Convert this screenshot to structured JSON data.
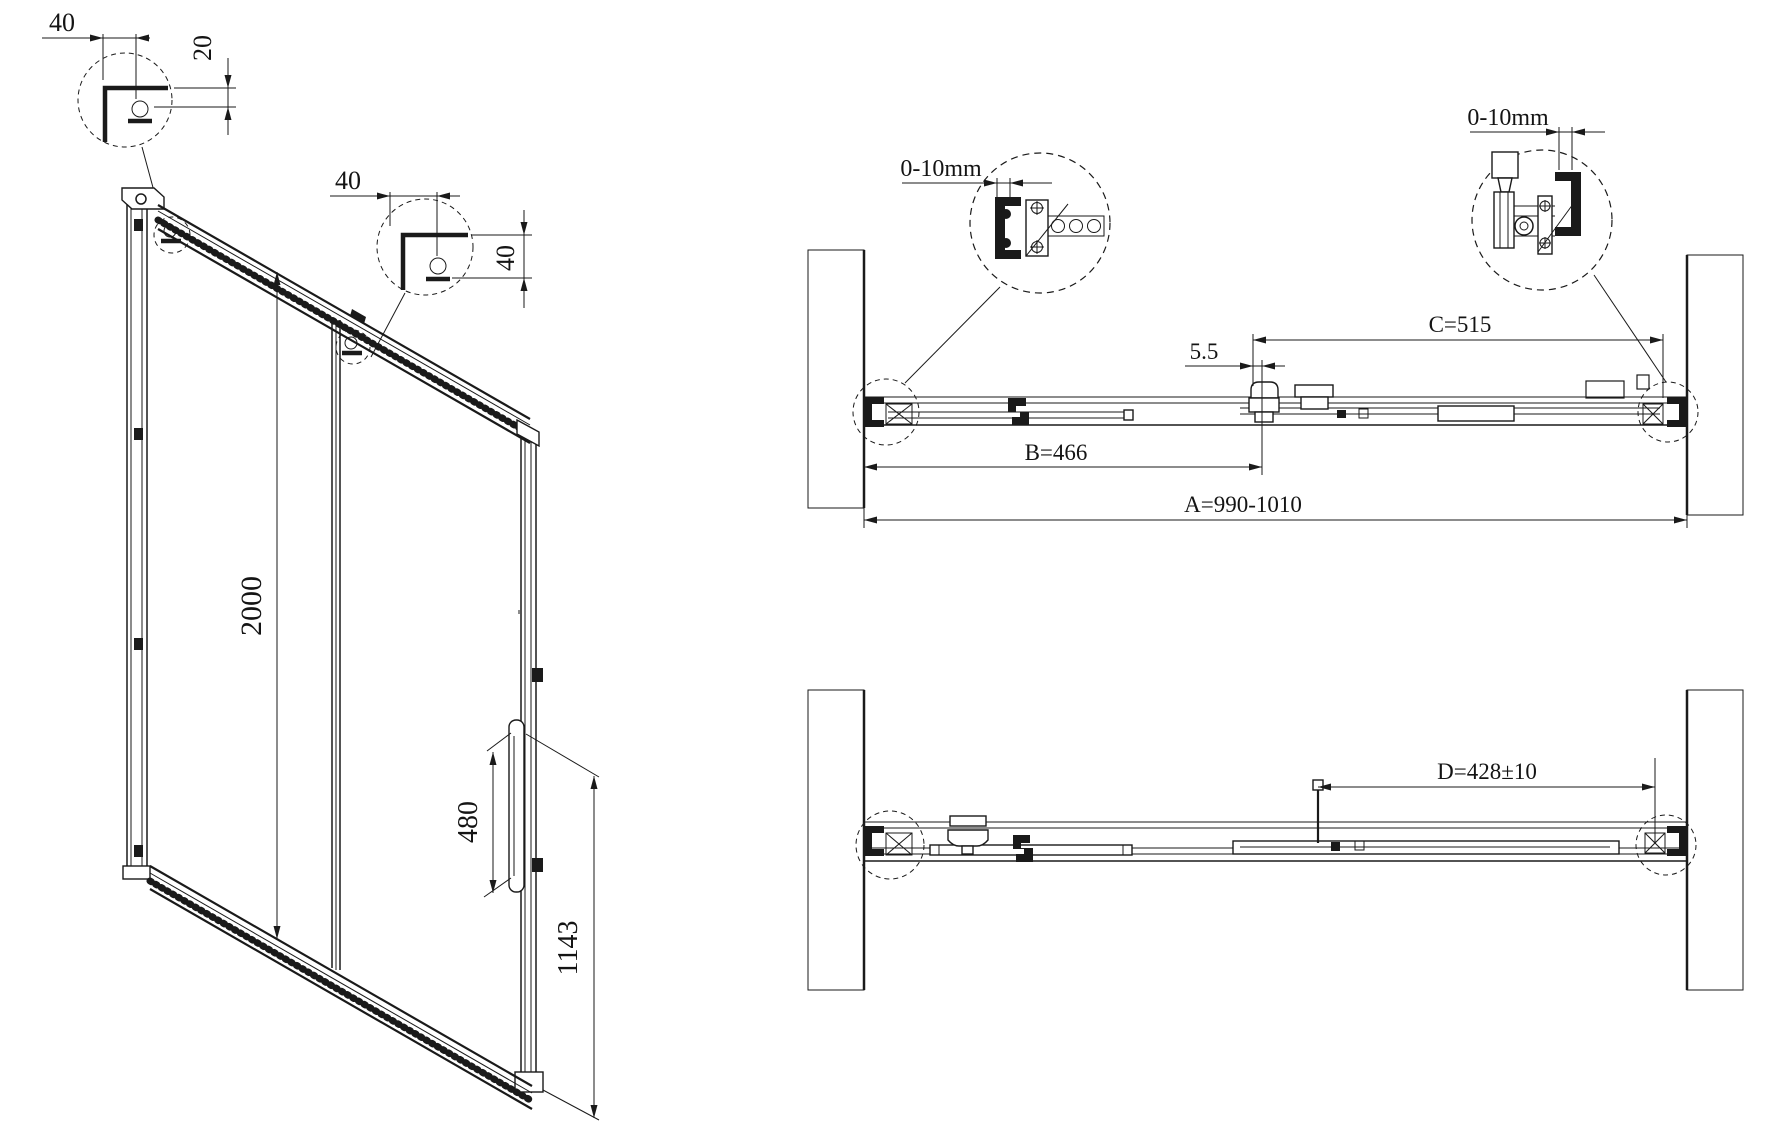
{
  "isometric": {
    "detail_top_left": {
      "dim_width": "40",
      "dim_height": "20"
    },
    "detail_top_mid": {
      "dim_width": "40",
      "dim_height": "40"
    },
    "dim_door_height": "2000",
    "dim_handle_length": "480",
    "dim_handle_bottom_height": "1143"
  },
  "plan_top": {
    "detail_left": {
      "dim_wall_gap": "0-10mm"
    },
    "detail_right": {
      "dim_wall_gap": "0-10mm"
    },
    "dim_overlap": "5.5",
    "dim_fixed_panel": "C=515",
    "dim_door_panel": "B=466",
    "dim_opening_width": "A=990-1010"
  },
  "plan_bottom": {
    "dim_travel": "D=428±10"
  }
}
